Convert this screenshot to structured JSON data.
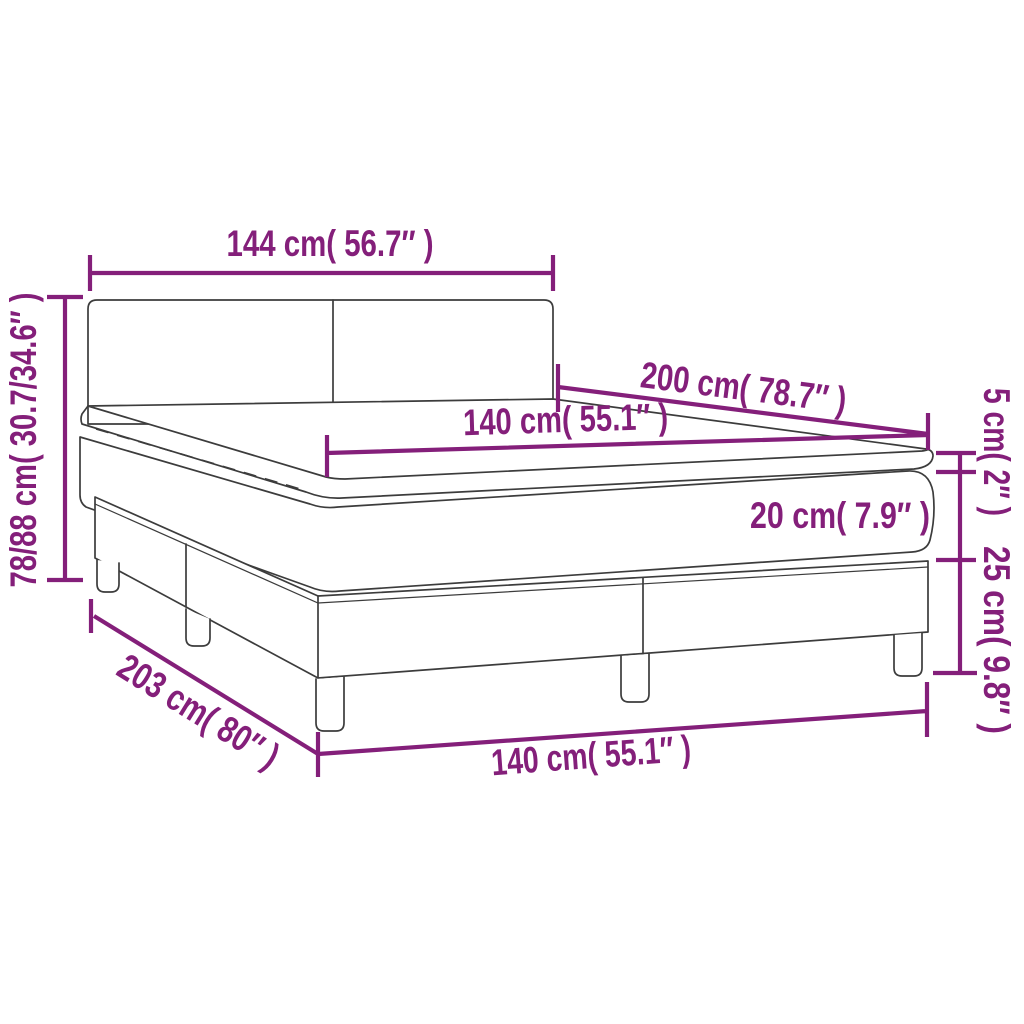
{
  "page": {
    "background": "#ffffff",
    "kind": "product-dimension-diagram",
    "subject": "box-spring-bed-with-mattress-and-topper"
  },
  "colors": {
    "dimension_accent": "#841f7a",
    "drawing_outline": "#3c3c3c",
    "background": "#ffffff"
  },
  "dimensions": [
    {
      "part": "headboard-width",
      "label": "144 cm( 56.7″ )"
    },
    {
      "part": "overall-height",
      "label": "78/88 cm( 30.7/34.6″ )"
    },
    {
      "part": "bed-length-top",
      "label": "200 cm( 78.7″ )"
    },
    {
      "part": "mattress-width",
      "label": "140 cm( 55.1″ )"
    },
    {
      "part": "topper-height",
      "label": "5 cm( 2″ )"
    },
    {
      "part": "mattress-height",
      "label": "20 cm( 7.9″ )"
    },
    {
      "part": "base-height",
      "label": "25 cm( 9.8″ )"
    },
    {
      "part": "base-length",
      "label": "203 cm( 80″ )"
    },
    {
      "part": "base-width",
      "label": "140 cm( 55.1″ )"
    }
  ]
}
